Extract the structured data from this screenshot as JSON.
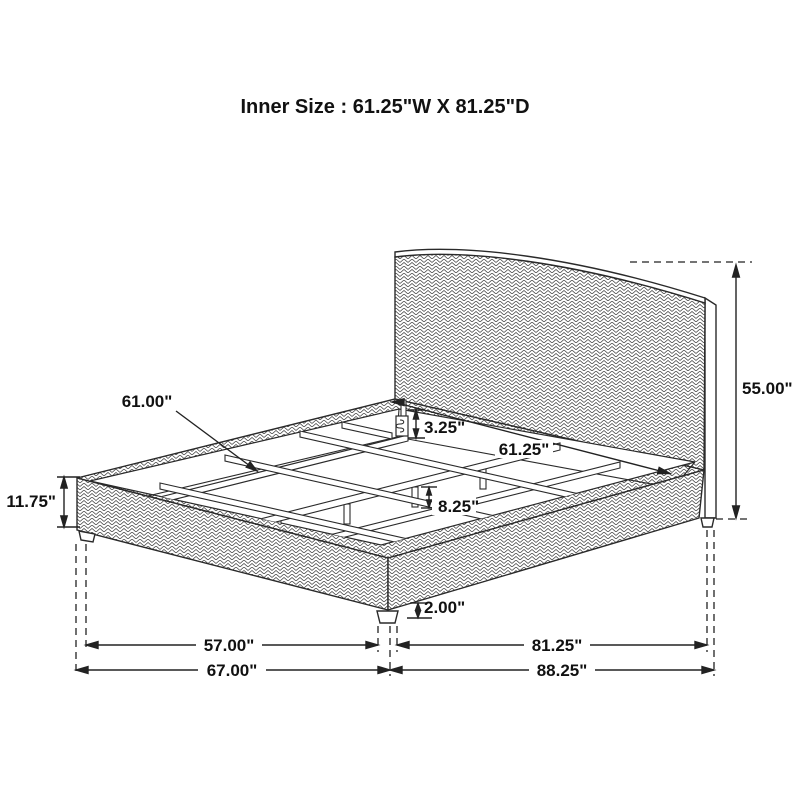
{
  "title": "Inner Size : 61.25\"W X 81.25\"D",
  "diagram_type": "bed-dimension-drawing",
  "labels": {
    "slat_length": "61.00\"",
    "rail_lip_height": "3.25\"",
    "inner_width": "61.25\"",
    "center_leg_height": "8.25\"",
    "side_rail_height": "11.75\"",
    "headboard_height": "55.00\"",
    "foot_leg_height": "2.00\"",
    "leg_span_width": "57.00\"",
    "overall_width": "67.00\"",
    "inner_depth": "81.25\"",
    "overall_depth": "88.25\""
  },
  "colors": {
    "line": "#2a2a2a",
    "pattern": "#404040",
    "background": "#ffffff"
  }
}
